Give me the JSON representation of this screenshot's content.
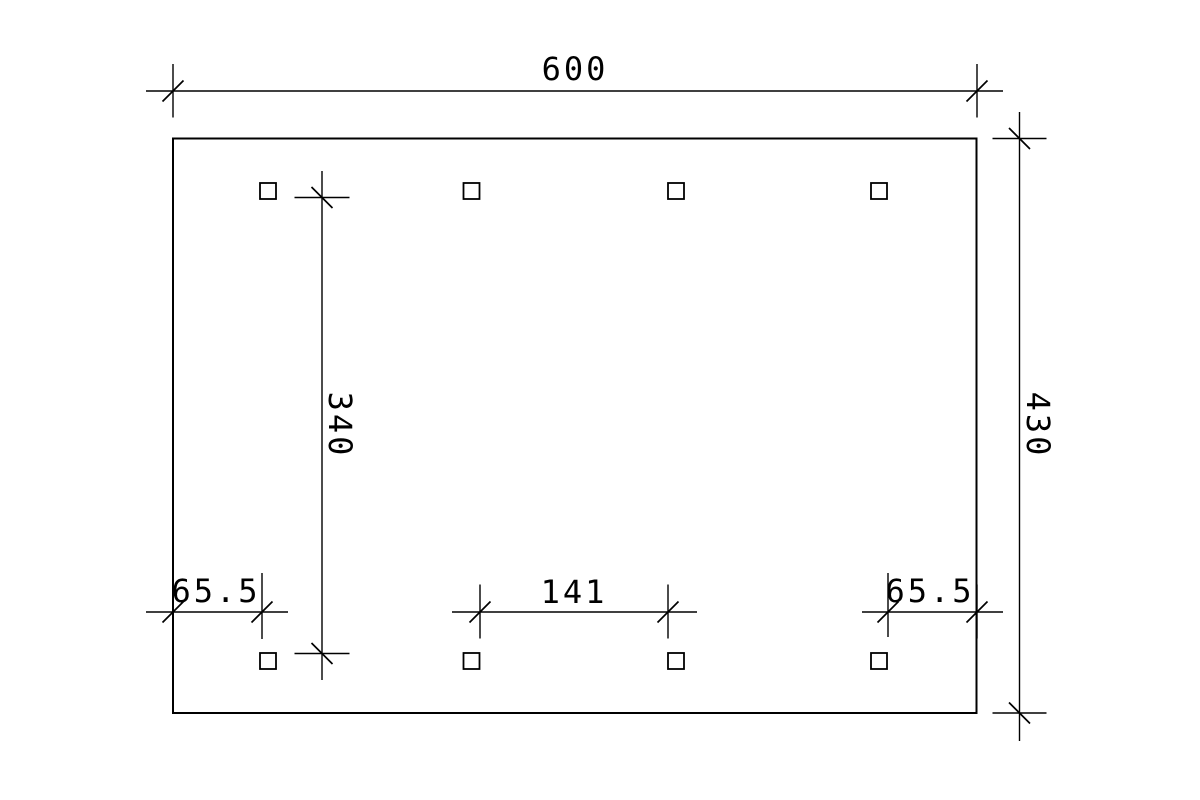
{
  "page": {
    "background_color": "#ffffff",
    "line_color": "#000000"
  },
  "drawing": {
    "type": "dimensioned foundation plan",
    "posts": {
      "rows": 2,
      "columns": 4,
      "marker_shape": "square"
    },
    "labels": {
      "overall_width": "600",
      "overall_depth": "430",
      "post_row_clear_spacing": "340",
      "post_clear_span": "141",
      "left_edge_offset": "65.5",
      "right_edge_offset": "65.5"
    }
  }
}
